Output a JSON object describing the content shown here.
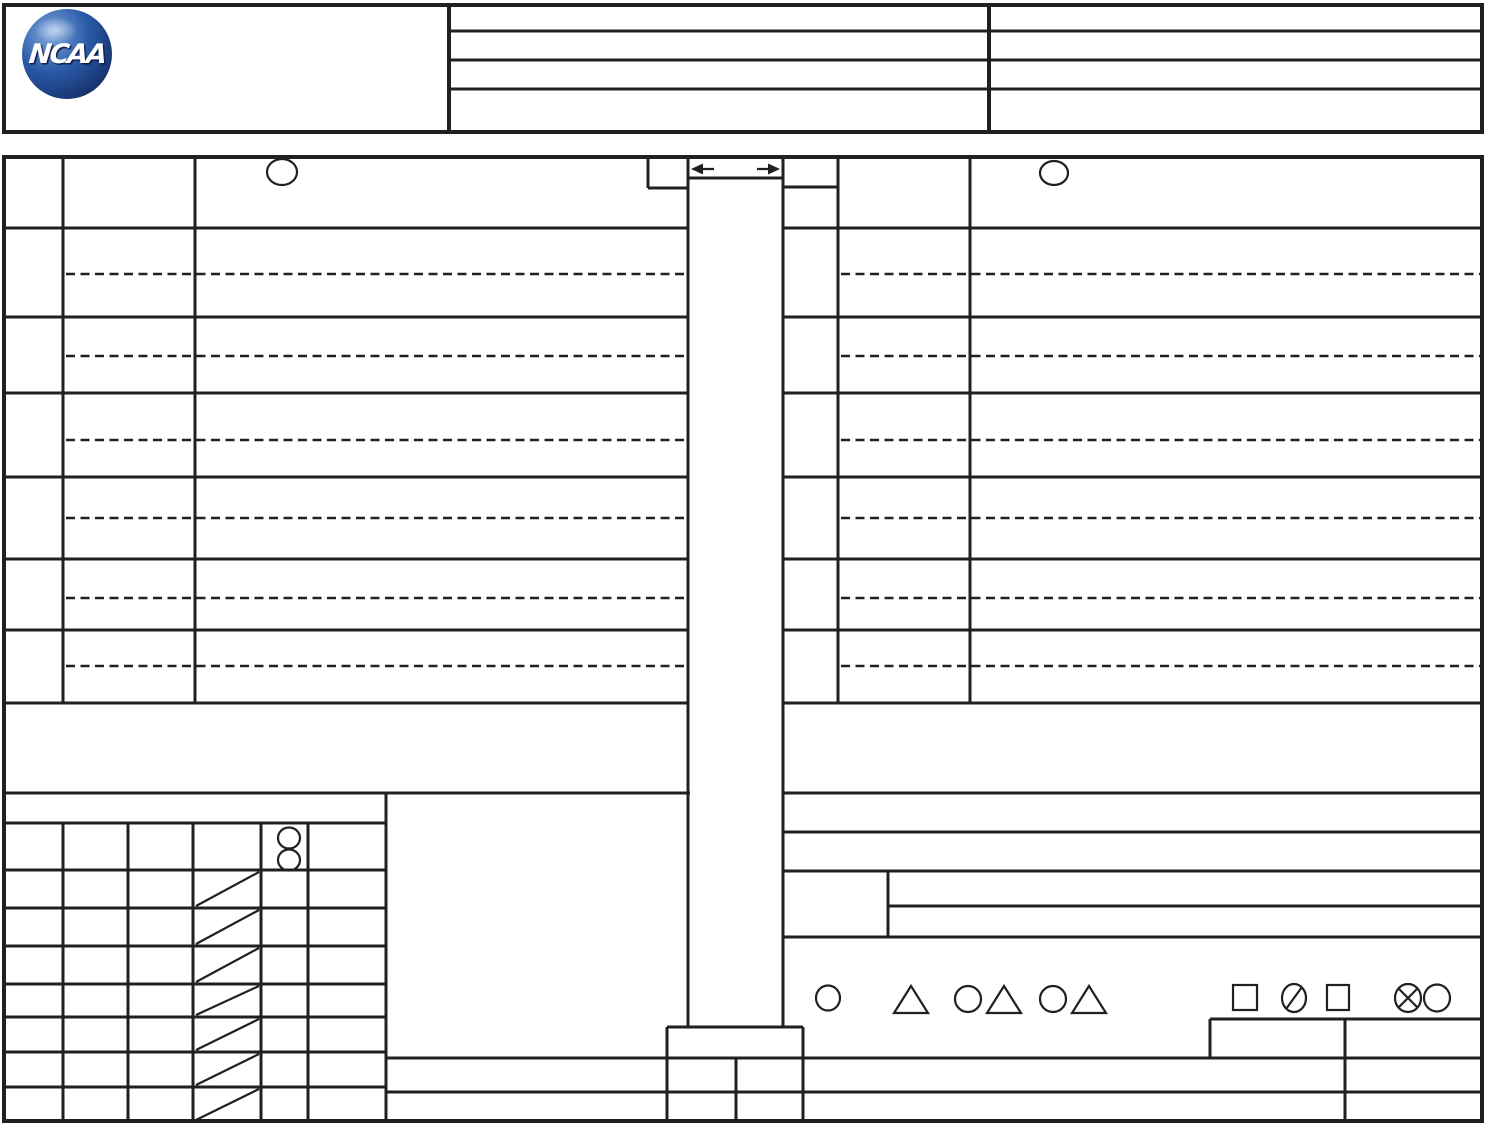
{
  "logo": {
    "text": "NCAA",
    "shape": "ncaa-globe-icon",
    "colors": {
      "sphere_main": "#2a5aa8",
      "sphere_dark": "#16336e",
      "sphere_highlight": "#7fa8dd",
      "text": "#ffffff"
    }
  },
  "colors": {
    "line": "#231f20",
    "background": "#ffffff"
  },
  "structure": {
    "header_info_tables": {
      "middle_rows": 4,
      "right_rows": 4,
      "all_rows_blank": true
    },
    "lineup_tables": {
      "sides": 2,
      "rows_per_side": 6,
      "dashed_substitution_line_per_row": true,
      "header_circle_per_side": 1
    },
    "center_strip": {
      "arrows": [
        "left-arrow",
        "right-arrow"
      ],
      "content": "blank score column"
    },
    "bottom_left_grid": {
      "header_strip_rows": 1,
      "grid_rows": 8,
      "grid_columns": 6,
      "double_circle_cell_row": 1,
      "diagonal_slash_rows": 7
    },
    "legend_symbols": [
      "circle",
      "triangle",
      "circle-triangle",
      "circle-triangle",
      "square",
      "slashed-circle",
      "square",
      "crossed-circle-with-circle"
    ],
    "visible_text": [
      "NCAA"
    ]
  }
}
